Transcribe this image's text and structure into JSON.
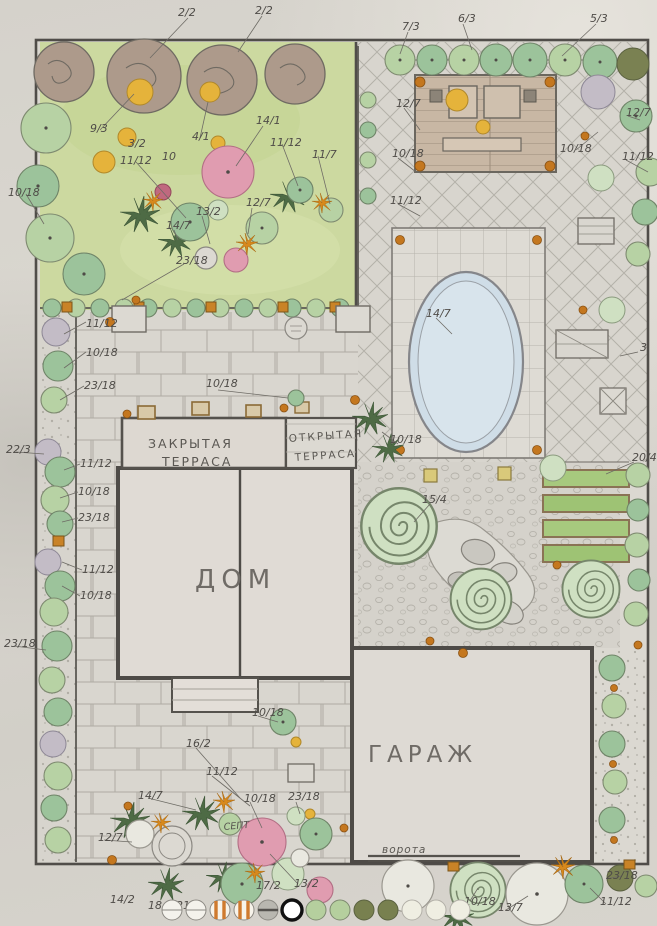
{
  "areas": {
    "house": "ДОМ",
    "garage": "ГАРАЖ",
    "closed_terrace_line1": "ЗАКРЫТАЯ",
    "closed_terrace_line2": "ТЕРРАСА",
    "open_terrace_line1": "ОТКРЫТАЯ",
    "open_terrace_line2": "ТЕРРАСА",
    "gate": "ворота",
    "septic": "СЕПТ"
  },
  "callouts": {
    "c1": "2/2",
    "c2": "2/2",
    "c3": "7/3",
    "c4": "6/3",
    "c5": "5/3",
    "c6": "10/18",
    "c7": "9/3",
    "c8": "3/2",
    "c9": "4/1",
    "c10": "14/1",
    "c11": "11/12",
    "c12": "10",
    "c13": "11/12",
    "c14": "11/7",
    "c15": "12/7",
    "c16": "13/2",
    "c17": "14/7",
    "c18": "23/18",
    "c19": "12/7",
    "c20": "10/18",
    "c21": "11/12",
    "c22": "12/7",
    "c23": "10/18",
    "c24": "11/12",
    "c25": "14/7",
    "c26": "3",
    "c27": "20/4",
    "c28": "10/18",
    "c29": "15/4",
    "c30": "11/12",
    "c31": "10/18",
    "c32": "23/18",
    "c33": "10/18",
    "c34": "22/3",
    "c35": "11/12",
    "c36": "10/18",
    "c37": "23/18",
    "c38": "11/12",
    "c39": "10/18",
    "c40": "23/18",
    "c41": "10/18",
    "c42": "16/2",
    "c43": "11/12",
    "c44": "14/7",
    "c45": "10/18",
    "c46": "23/18",
    "c47": "12/7",
    "c48": "14/2",
    "c49": "18",
    "c50": "21",
    "c51": "13/2",
    "c52": "17/2",
    "c53": "10/18",
    "c54": "13/7",
    "c55": "23/18",
    "c56": "11/12"
  },
  "legend": {
    "swatches": [
      {
        "color": "#f4f2ec"
      },
      {
        "color": "#f4f2ec"
      },
      {
        "color": "#f7f3ea"
      },
      {
        "color": "#f7f3ea"
      },
      {
        "color": "#b9b7b0"
      },
      {
        "color": "#ffffff"
      },
      {
        "color": "#b5cf9e"
      },
      {
        "color": "#b5cf9e"
      },
      {
        "color": "#78804f"
      },
      {
        "color": "#78804f"
      },
      {
        "color": "#efeee2"
      },
      {
        "color": "#efeee2"
      },
      {
        "color": "#efeee2"
      }
    ]
  },
  "colors": {
    "paper": "#d6d3cc",
    "pencil": "#4f4c48",
    "lawn": "#ccd9a0",
    "pool_water": "#cfdde7",
    "accent_orange": "#c4771f",
    "accent_yellow": "#e5b33b",
    "pink_flower": "#e09cb0",
    "wood": "#c8b7a4"
  }
}
